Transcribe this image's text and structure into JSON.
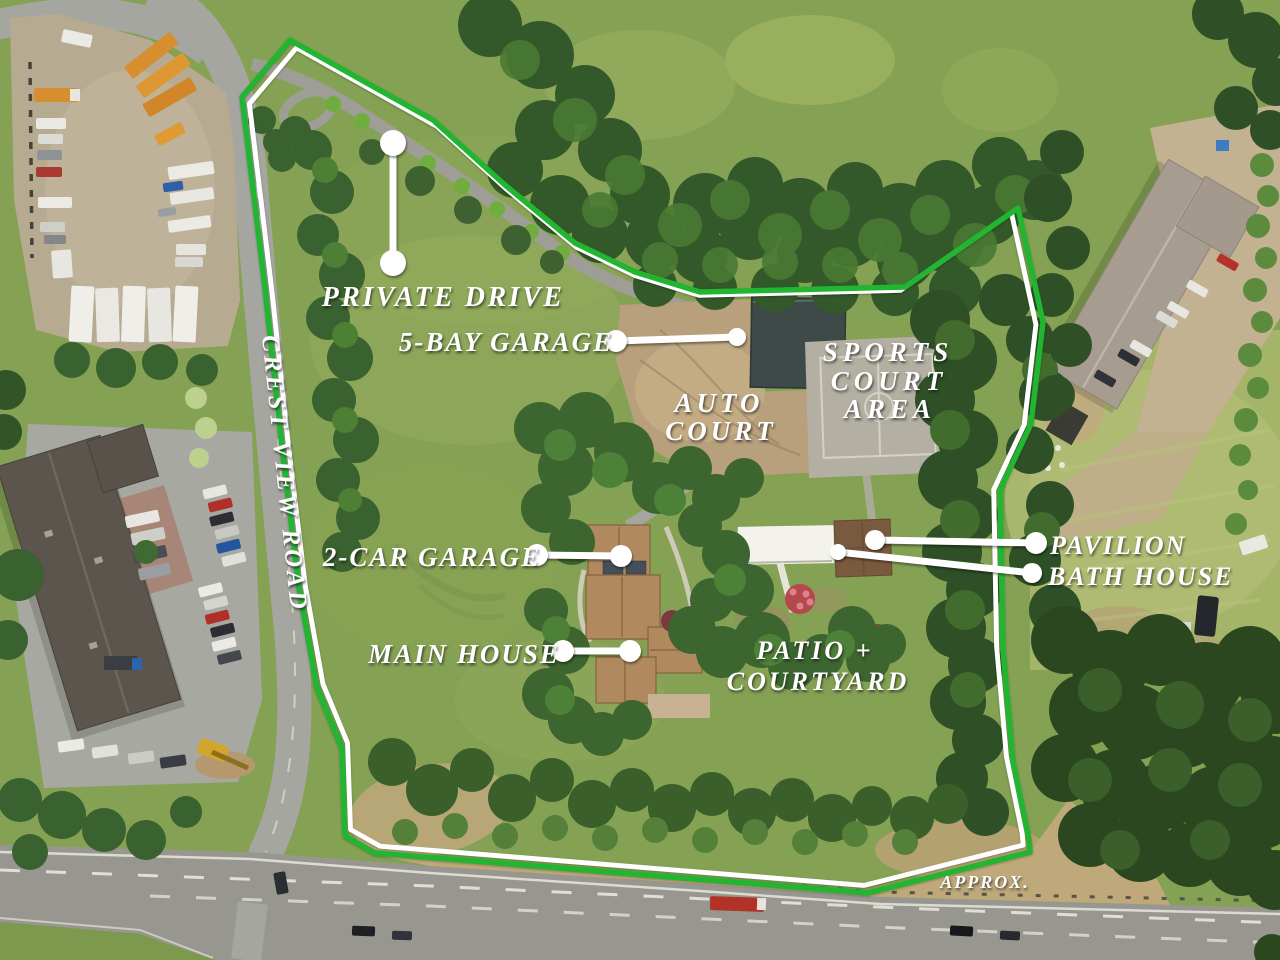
{
  "colors": {
    "boundary_green": "#22b532",
    "boundary_casing": "#ffffff",
    "leader_white": "#ffffff",
    "label_text": "#ffffff"
  },
  "labels": {
    "private_drive": {
      "text": "PRIVATE DRIVE"
    },
    "five_bay_garage": {
      "text": "5-BAY GARAGE"
    },
    "sports_court_area": {
      "line1": "SPORTS",
      "line2": "COURT",
      "line3": "AREA"
    },
    "auto_court": {
      "line1": "AUTO",
      "line2": "COURT"
    },
    "crest_view_road": {
      "text": "CREST VIEW ROAD"
    },
    "two_car_garage": {
      "text": "2-CAR GARAGE"
    },
    "pavilion": {
      "text": "PAVILION"
    },
    "bath_house": {
      "text": "BATH HOUSE"
    },
    "main_house": {
      "text": "MAIN HOUSE"
    },
    "patio_courtyard": {
      "line1": "PATIO +",
      "line2": "COURTYARD"
    },
    "approx": {
      "text": "APPROX."
    }
  }
}
